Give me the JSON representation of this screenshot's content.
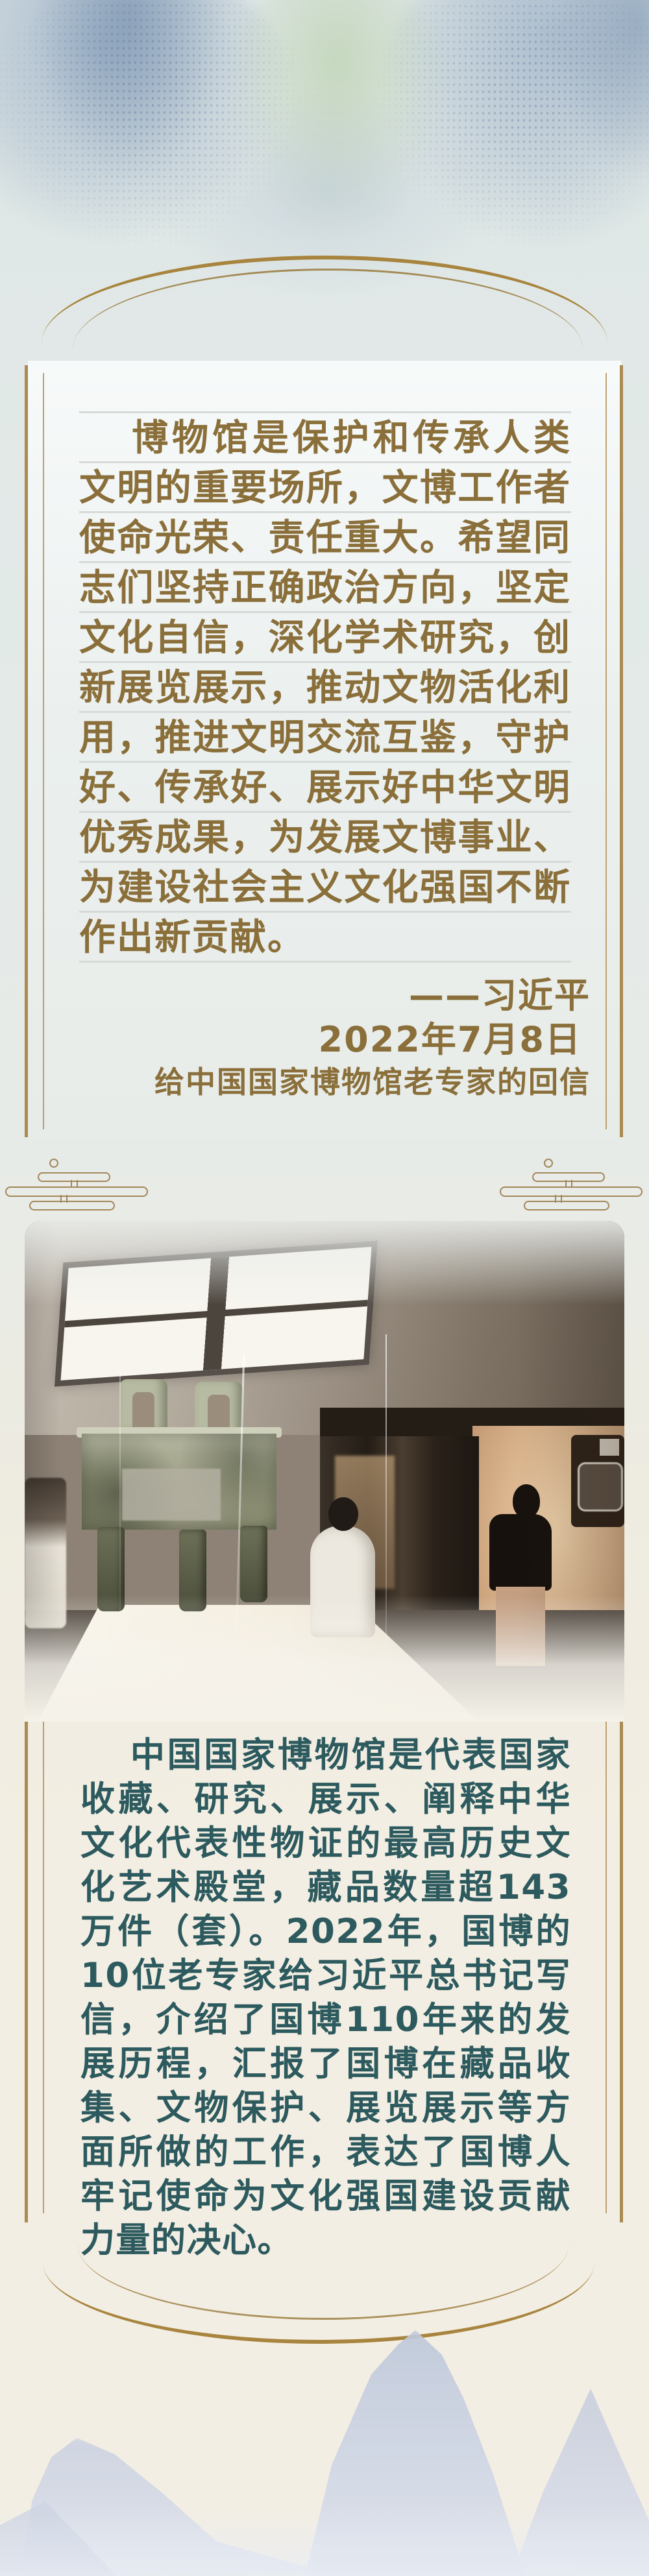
{
  "quote": {
    "text": "博物馆是保护和传承人类文明的重要场所，文博工作者使命光荣、责任重大。希望同志们坚持正确政治方向，坚定文化自信，深化学术研究，创新展览展示，推动文物活化利用，推进文明交流互鉴，守护好、传承好、展示好中华文明优秀成果，为发展文博事业、为建设社会主义文化强国不断作出新贡献。",
    "author": "——习近平",
    "date": "2022年7月8日",
    "source": "给中国国家博物馆老专家的回信"
  },
  "article": {
    "paragraph": "中国国家博物馆是代表国家收藏、研究、展示、阐释中华文化代表性物证的最高历史文化艺术殿堂，藏品数量超143万件（套）。2022年，国博的10位老专家给习近平总书记写信，介绍了国博110年来的发展历程，汇报了国博在藏品收集、文物保护、展览展示等方面所做的工作，表达了国博人牢记使命为文化强国建设贡献力量的决心。"
  },
  "decorations": {
    "top_arc_icon": "double-gold-arc",
    "bottom_arc_icon": "double-gold-arc-inverted",
    "ornament_icon": "ruyi-cloud-bars",
    "photo_subject_icon": "bronze-square-ding-exhibit"
  },
  "colors": {
    "accent_gold": "#ab8b52",
    "quote_text": "#8a6f3a",
    "body_text": "#2d5a5e",
    "rule_line": "#d6dad8",
    "background_top": "#e3eae8",
    "background_bottom": "#f3eee3"
  }
}
